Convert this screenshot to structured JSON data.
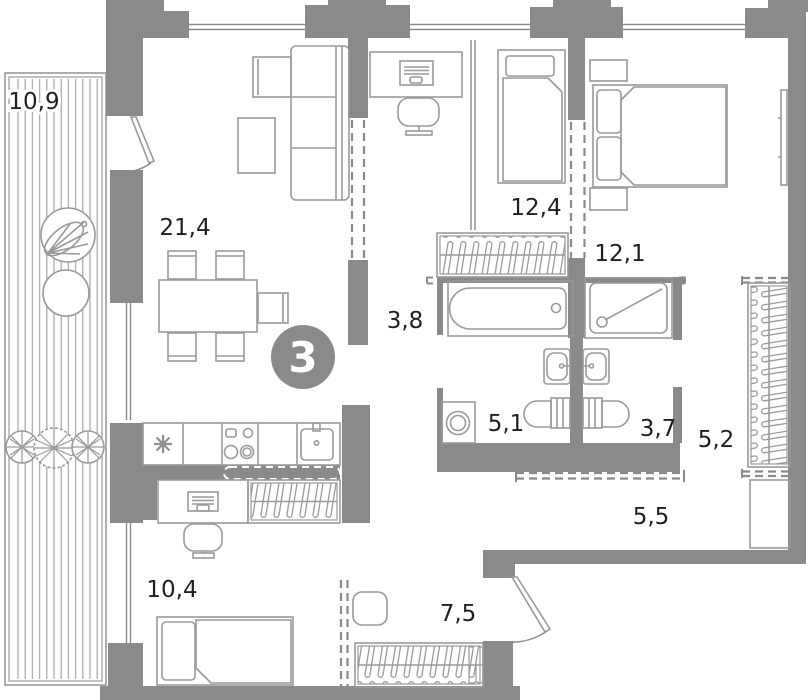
{
  "plan": {
    "title": "apartment-floor-plan",
    "badge_rooms": "3",
    "rooms": [
      {
        "name": "balcony",
        "area": "10,9"
      },
      {
        "name": "living-room",
        "area": "21,4"
      },
      {
        "name": "workspace-nook",
        "area": "3,8"
      },
      {
        "name": "bedroom-1",
        "area": "12,4"
      },
      {
        "name": "bedroom-2",
        "area": "12,1"
      },
      {
        "name": "bathroom",
        "area": "5,1"
      },
      {
        "name": "shower-room",
        "area": "3,7"
      },
      {
        "name": "wardrobe-area",
        "area": "5,2"
      },
      {
        "name": "hallway",
        "area": "5,5"
      },
      {
        "name": "bedroom-3",
        "area": "10,4"
      },
      {
        "name": "entry-hall",
        "area": "7,5"
      }
    ],
    "colors": {
      "wall": "#8a8a8a",
      "furniture_line": "#9a9a9a",
      "label_text": "#1f1f1f",
      "badge_fill": "#8a8a8a",
      "badge_text": "#ffffff",
      "background": "#ffffff"
    }
  }
}
